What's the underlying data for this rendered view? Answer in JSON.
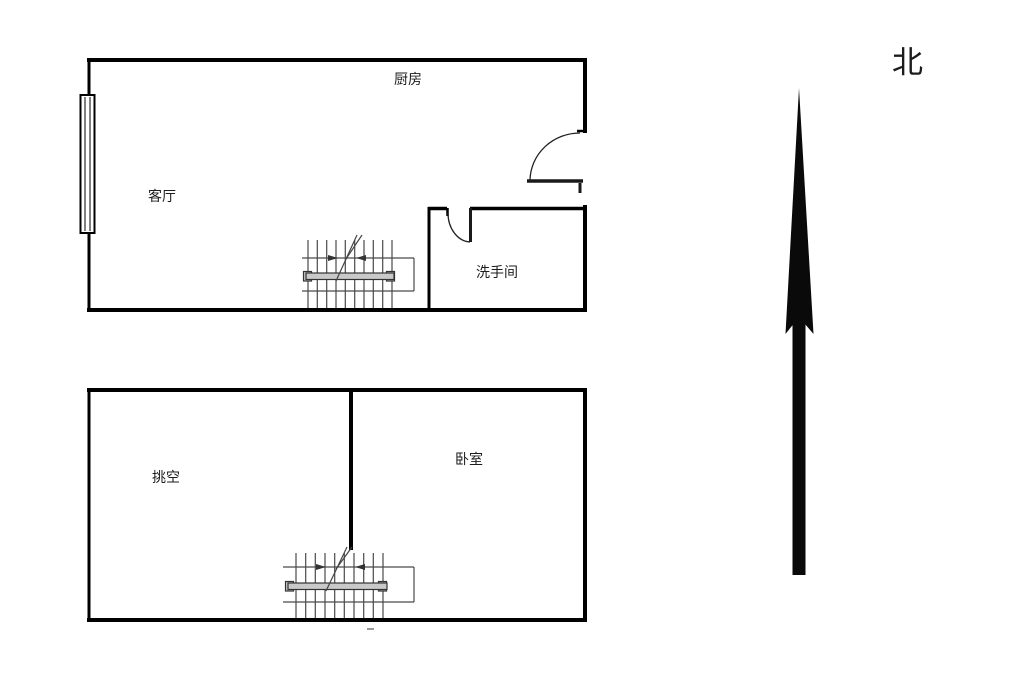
{
  "canvas": {
    "width": 1024,
    "height": 680,
    "background": "#ffffff"
  },
  "colors": {
    "wall": "#000000",
    "door": "#1a1a1a",
    "stair_line": "#4a4a4a",
    "handrail_fill": "#c9c9c9",
    "handrail_stroke": "#333333",
    "north_arrow": "#0a0a0a"
  },
  "floor_plans": [
    {
      "id": "level-1",
      "rooms": [
        {
          "name": "kitchen",
          "label": "厨房"
        },
        {
          "name": "living-room",
          "label": "客厅"
        },
        {
          "name": "bathroom",
          "label": "洗手间"
        }
      ]
    },
    {
      "id": "level-2",
      "rooms": [
        {
          "name": "void",
          "label": "挑空"
        },
        {
          "name": "bedroom",
          "label": "卧室"
        }
      ]
    }
  ],
  "compass": {
    "north_label": "北"
  }
}
